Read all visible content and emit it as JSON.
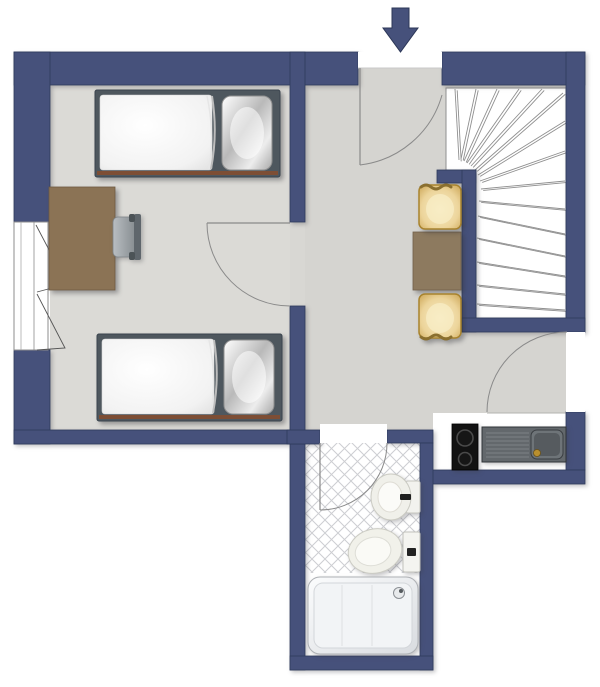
{
  "plan": {
    "type": "apartment-floor-plan",
    "orientation": "top-down",
    "entrance": {
      "symbol": "arrow-down",
      "position": "top-center"
    }
  },
  "palette": {
    "background": "#ffffff",
    "wall": "#46517b",
    "wall_outline": "#2e3a5c",
    "bedroom_floor": "#dbdad6",
    "hall_floor": "#d5d4d0",
    "wet_room_floor": "#ffffff",
    "tile_line": "#cdced2",
    "stair_tread_line": "#8f8f8f",
    "door_arc": "#8a8a8a",
    "desk_wood": "#8b7355",
    "table_wood": "#8d7a5f",
    "chair_gold": "#e9d49c",
    "chair_gold_edge": "#8a6f2f",
    "bed_frame": "#4e575e",
    "bed_wood_rail": "#7d4e35",
    "office_chair_gray": "#9aa0a4",
    "cooktop_black": "#121212",
    "sink_gray": "#63686c",
    "fixture_white": "#f1f1ec",
    "faucet_gold": "#b98f2e"
  },
  "rooms": [
    {
      "id": "bedroom",
      "floor": "light-gray"
    },
    {
      "id": "hall",
      "floor": "light-gray"
    },
    {
      "id": "staircase",
      "floor": "white",
      "stairs": {
        "treads": 15,
        "shape": "winder-quarter-turn"
      }
    },
    {
      "id": "kitchenette",
      "floor": "white"
    },
    {
      "id": "bathroom",
      "floor": "white-diagonal-tiles"
    }
  ],
  "openings": [
    {
      "id": "entrance-door",
      "wall": "top",
      "swing": "inward"
    },
    {
      "id": "bedroom-door",
      "wall": "bedroom-right",
      "swing": "into-bedroom"
    },
    {
      "id": "hall-side-door",
      "wall": "right",
      "swing": "into-hall"
    },
    {
      "id": "bathroom-door",
      "wall": "bathroom-top",
      "swing": "into-bathroom"
    },
    {
      "id": "window",
      "wall": "left",
      "type": "double-casement"
    }
  ],
  "furniture": [
    {
      "id": "bed-1",
      "type": "single-bed",
      "pillow": "right"
    },
    {
      "id": "bed-2",
      "type": "single-bed",
      "pillow": "right"
    },
    {
      "id": "desk",
      "type": "desk"
    },
    {
      "id": "desk-chair",
      "type": "office-chair"
    },
    {
      "id": "dining-table",
      "type": "square-table"
    },
    {
      "id": "dining-chair-1",
      "type": "upholstered-chair"
    },
    {
      "id": "dining-chair-2",
      "type": "upholstered-chair"
    }
  ],
  "fixtures": [
    {
      "id": "cooktop",
      "type": "two-burner-hob"
    },
    {
      "id": "sink-unit",
      "type": "sink-with-drainboard"
    },
    {
      "id": "bidet",
      "type": "bidet"
    },
    {
      "id": "toilet",
      "type": "toilet"
    },
    {
      "id": "bathtub",
      "type": "bathtub"
    }
  ]
}
